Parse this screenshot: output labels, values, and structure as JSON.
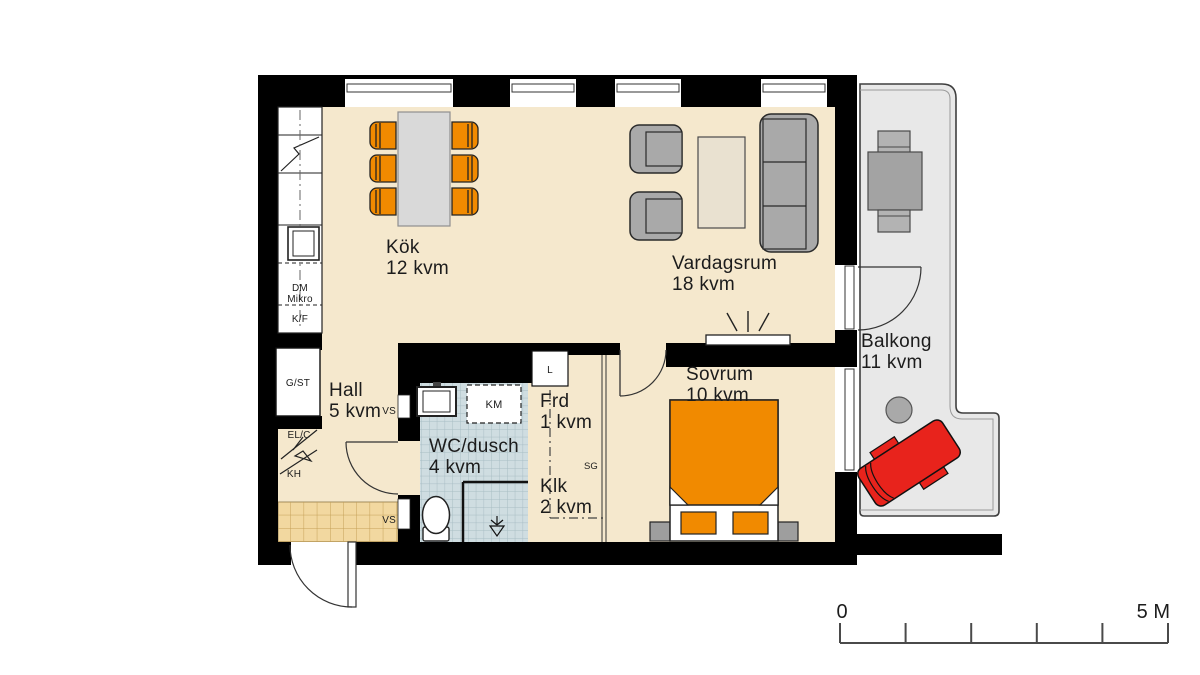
{
  "rooms": {
    "kitchen": {
      "name": "Kök",
      "area": "12 kvm"
    },
    "living_room": {
      "name": "Vardagsrum",
      "area": "18 kvm"
    },
    "hall": {
      "name": "Hall",
      "area": "5 kvm"
    },
    "bathroom": {
      "name": "WC/dusch",
      "area": "4 kvm"
    },
    "storage": {
      "name": "Frd",
      "area": "1 kvm"
    },
    "walk_in_closet": {
      "name": "Klk",
      "area": "2 kvm"
    },
    "bedroom": {
      "name": "Sovrum",
      "area": "10 kvm"
    },
    "balcony": {
      "name": "Balkong",
      "area": "11 kvm"
    }
  },
  "fixtures": {
    "dishwasher": "DM",
    "microwave": "Mikro",
    "fridge_freezer": "K/F",
    "wardrobe_cleaning": "G/ST",
    "electrical_cabinet": "EL/C",
    "coat_rack": "KH",
    "shaft_upper": "VS",
    "shaft_lower": "VS",
    "linen_cabinet": "L",
    "washing_machine": "KM",
    "sliding_doors": "SG"
  },
  "scale_bar": {
    "start_label": "0",
    "end_label": "5 M"
  },
  "colors": {
    "wall": "#000000",
    "floor": "#f5e8cd",
    "bathroom_tile": "#cfdde1",
    "entry_tile": "#f2d8a0",
    "balcony_floor": "#e8e8e8",
    "furniture_gray": "#a9a9a9",
    "table_gray": "#d9d9d9",
    "coffee_table": "#e9e1d0",
    "accent_orange": "#f18a00",
    "lounger_red": "#e8231c"
  }
}
